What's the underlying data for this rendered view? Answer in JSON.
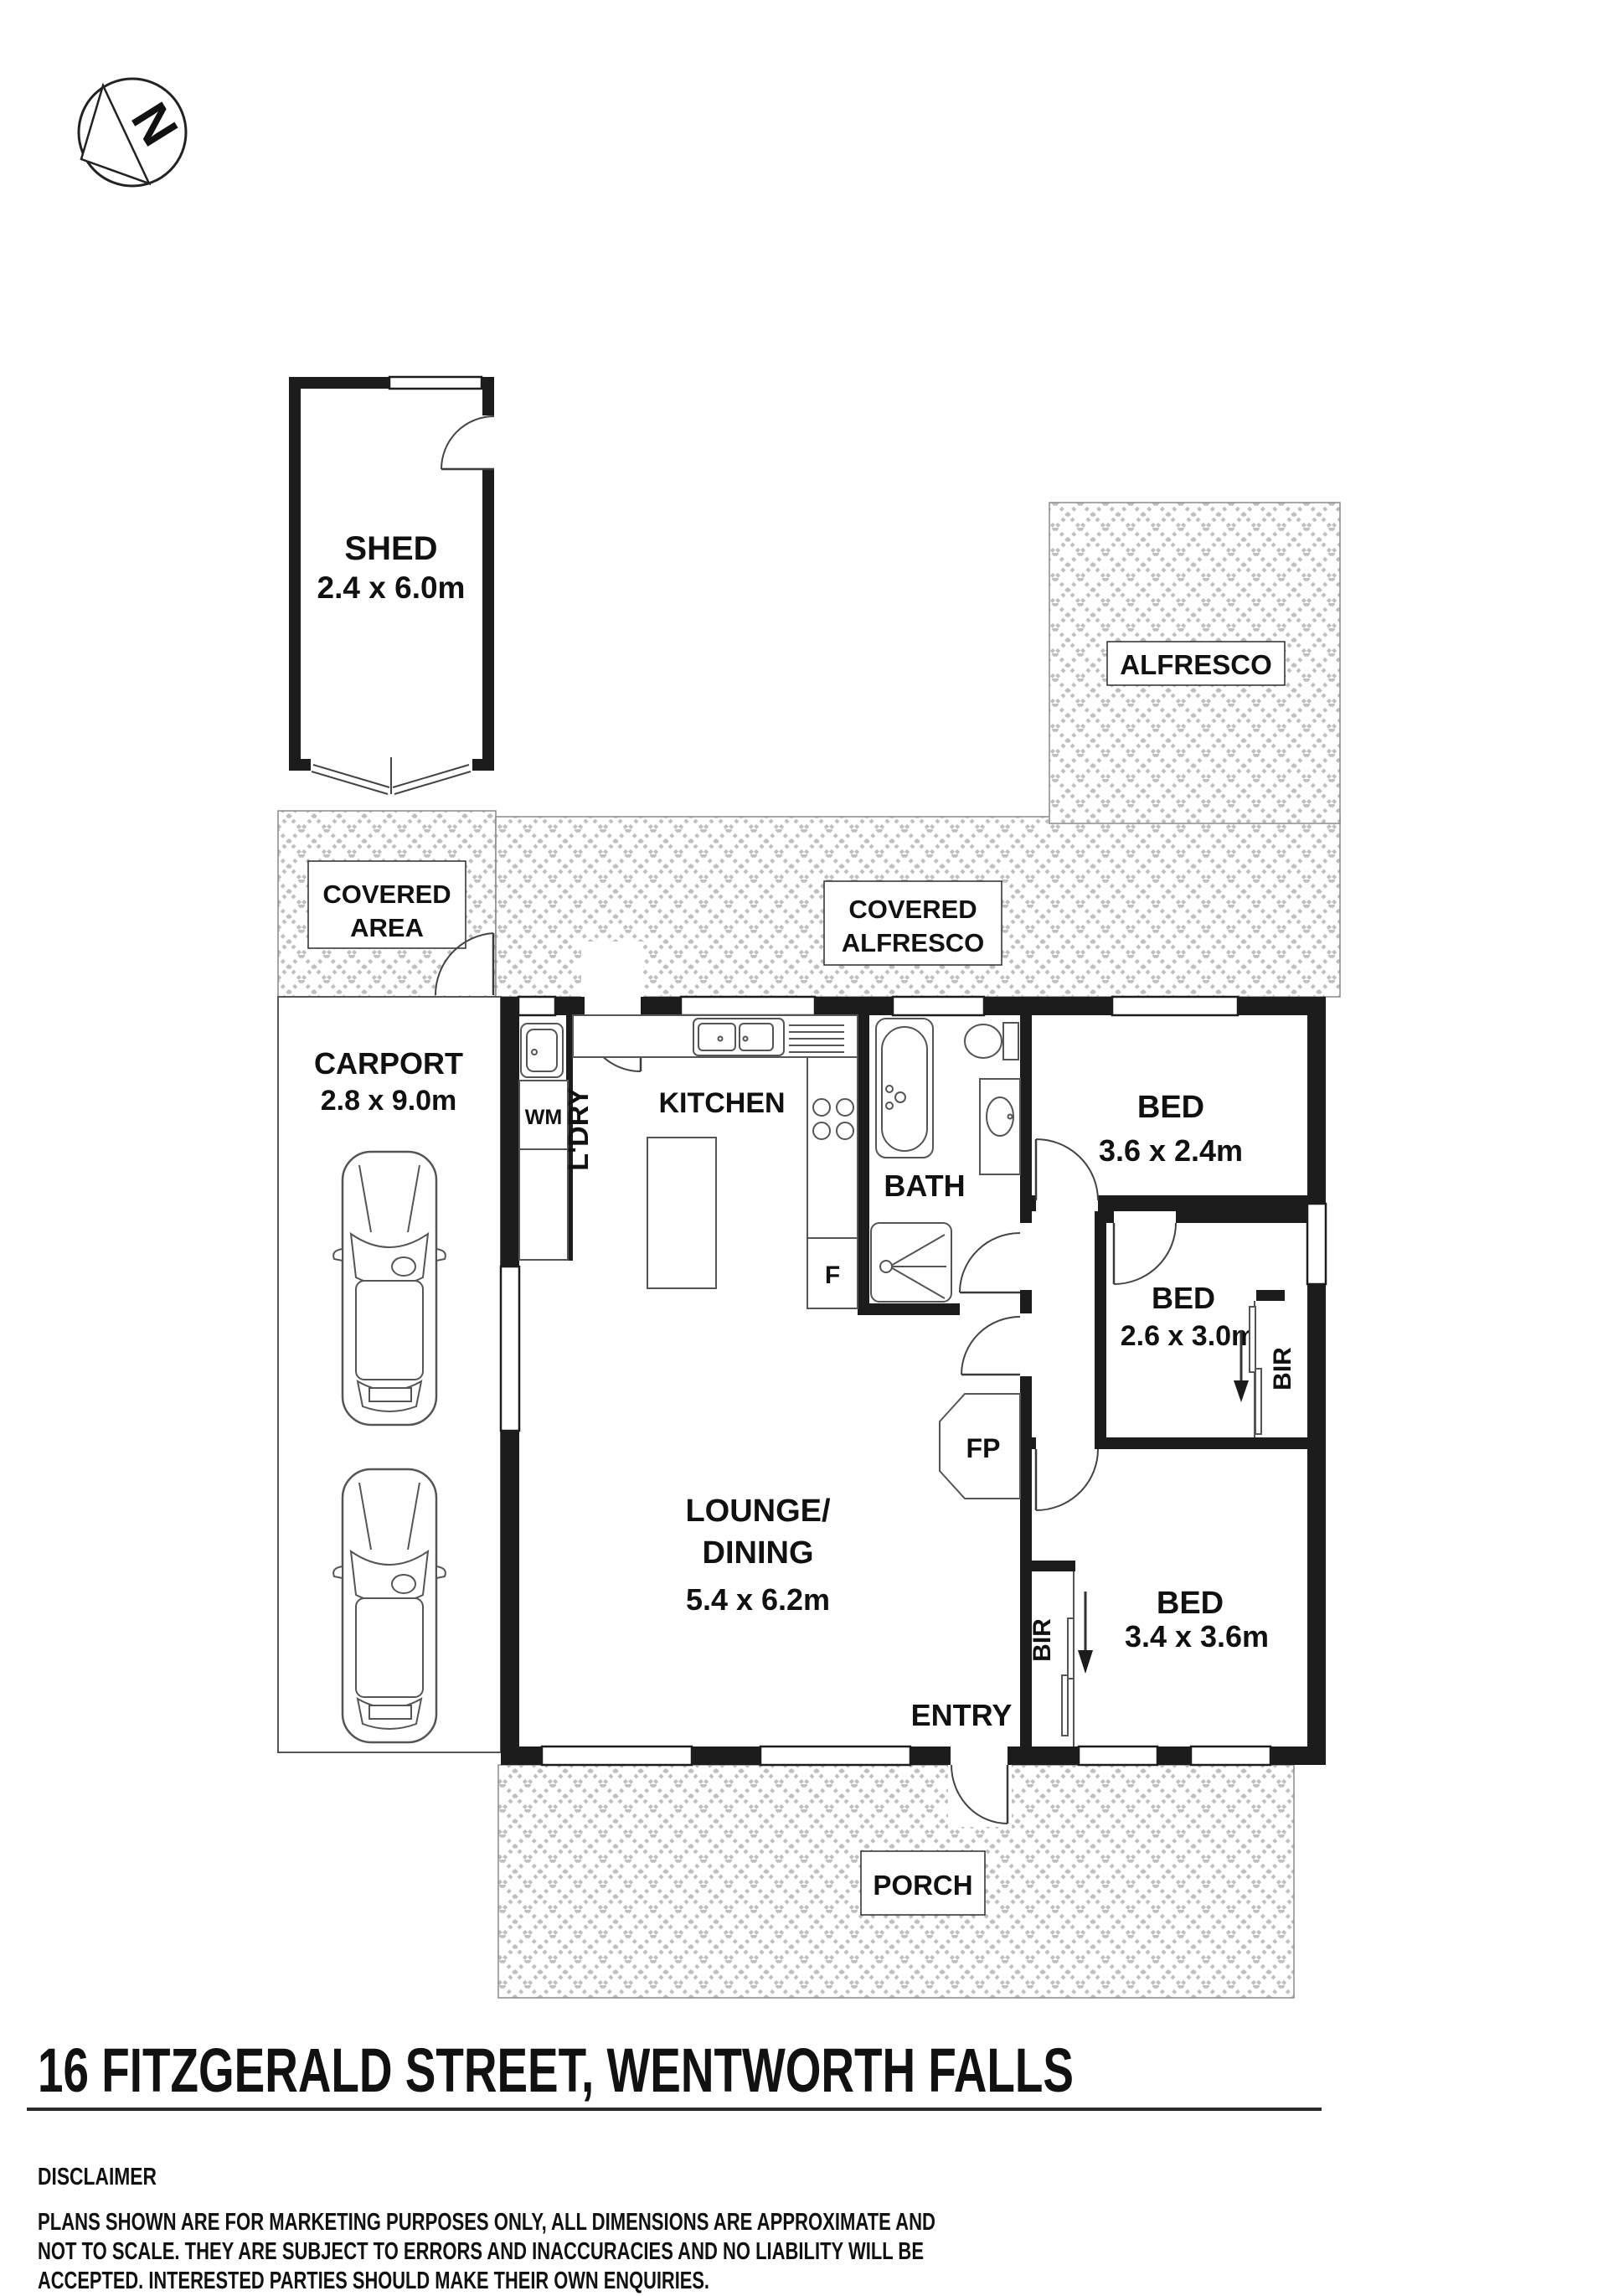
{
  "compass": {
    "north": "N"
  },
  "rooms": {
    "shed": {
      "name": "SHED",
      "dims": "2.4 x 6.0m"
    },
    "covered_area": {
      "line1": "COVERED",
      "line2": "AREA"
    },
    "alfresco": {
      "name": "ALFRESCO"
    },
    "covered_alfresco": {
      "line1": "COVERED",
      "line2": "ALFRESCO"
    },
    "carport": {
      "name": "CARPORT",
      "dims": "2.8 x 9.0m"
    },
    "laundry": {
      "name": "L'DRY",
      "washer": "WM"
    },
    "kitchen": {
      "name": "KITCHEN",
      "fridge": "F"
    },
    "bath": {
      "name": "BATH"
    },
    "bed1": {
      "name": "BED",
      "dims": "3.6 x 2.4m"
    },
    "bed2": {
      "name": "BED",
      "dims": "2.6 x 3.0m",
      "robe": "BIR"
    },
    "bed3": {
      "name": "BED",
      "dims": "3.4 x 3.6m",
      "robe": "BIR"
    },
    "lounge": {
      "line1": "LOUNGE/",
      "line2": "DINING",
      "dims": "5.4 x 6.2m"
    },
    "entry": {
      "name": "ENTRY"
    },
    "fireplace": {
      "label": "FP"
    },
    "porch": {
      "name": "PORCH"
    }
  },
  "footer": {
    "address": "16 FITZGERALD STREET, WENTWORTH FALLS",
    "disclaimer_heading": "DISCLAIMER",
    "disclaimer_line1": "PLANS SHOWN ARE FOR MARKETING PURPOSES ONLY, ALL DIMENSIONS ARE APPROXIMATE AND",
    "disclaimer_line2": "NOT TO SCALE. THEY ARE SUBJECT TO ERRORS AND INACCURACIES AND NO LIABILITY WILL BE",
    "disclaimer_line3": "ACCEPTED. INTERESTED PARTIES SHOULD MAKE THEIR OWN ENQUIRIES."
  },
  "colors": {
    "wall": "#1c1c1c",
    "hatch": "#bfbfbf",
    "text": "#111111"
  }
}
